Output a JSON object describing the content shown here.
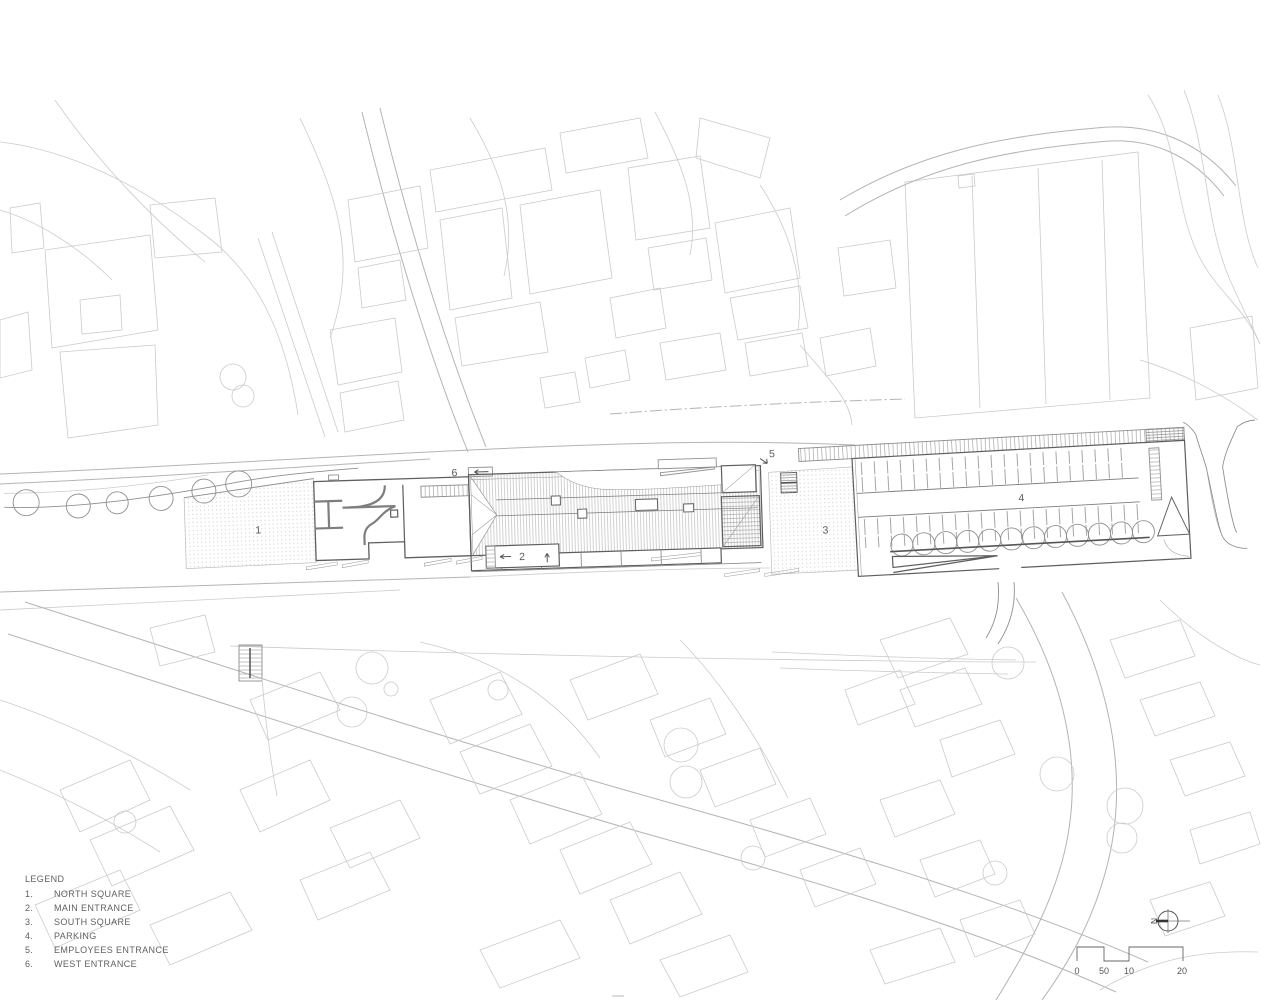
{
  "plan": {
    "labels": {
      "north_square_num": "1",
      "main_entrance_num": "2",
      "south_square_num": "3",
      "parking_num": "4",
      "employees_entrance_num": "5",
      "west_entrance_num": "6"
    }
  },
  "legend": {
    "title": "LEGEND",
    "items": [
      {
        "num": "1.",
        "label": "NORTH SQUARE"
      },
      {
        "num": "2.",
        "label": "MAIN ENTRANCE"
      },
      {
        "num": "3.",
        "label": "SOUTH SQUARE"
      },
      {
        "num": "4.",
        "label": "PARKING"
      },
      {
        "num": "5.",
        "label": "EMPLOYEES ENTRANCE"
      },
      {
        "num": "6.",
        "label": "WEST ENTRANCE"
      }
    ]
  },
  "north_arrow": {
    "label": "N"
  },
  "scale_bar": {
    "ticks": [
      "0",
      "50",
      "10",
      "20"
    ]
  },
  "colors": {
    "context_line": "#cbcbcb",
    "road_line": "#b4b4b4",
    "building_line": "#5e5e5e",
    "hatch_line": "#a6a6a6",
    "text": "#606060"
  }
}
